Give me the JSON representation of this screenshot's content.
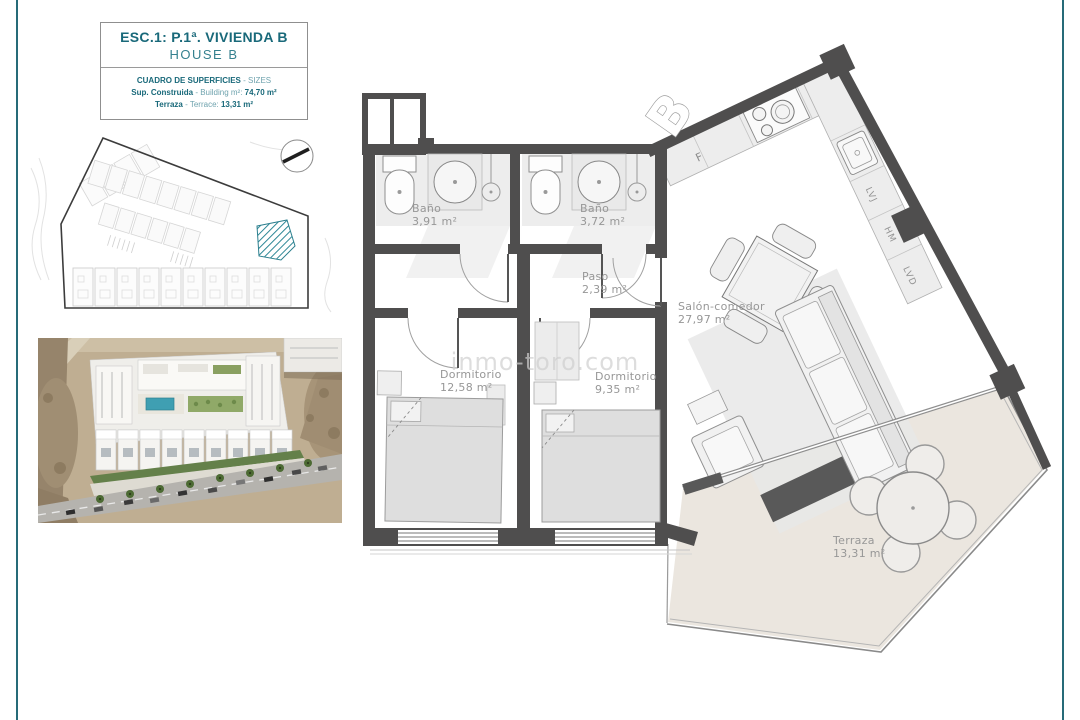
{
  "page": {
    "bg": "#ffffff",
    "frame_color": "#266b78"
  },
  "title_box": {
    "line1": "ESC.1: P.1ª. VIVIENDA B",
    "line2": "HOUSE B",
    "sizes_title": "CUADRO DE SUPERFICIES",
    "sizes_title_suffix": "- SIZES",
    "built_label": "Sup. Construida",
    "built_mid": "- Building m²:",
    "built_value": "74,70 m²",
    "terrace_label": "Terraza",
    "terrace_mid": "- Terrace:",
    "terrace_value": "13,31 m²"
  },
  "site_plan": {
    "highlight_color": "#2e8897"
  },
  "floor_plan": {
    "unit_letter": "B",
    "kitchen_fridge_label": "F",
    "appliances": [
      "LVJ",
      "HM",
      "LVD"
    ],
    "rooms": {
      "bath1": {
        "name": "Baño",
        "area": "3,91 m²"
      },
      "bath2": {
        "name": "Baño",
        "area": "3,72 m²"
      },
      "paso": {
        "name": "Paso",
        "area": "2,39 m²"
      },
      "salon": {
        "name": "Salón-comedor",
        "area": "27,97 m²"
      },
      "dorm1": {
        "name": "Dormitorio",
        "area": "12,58 m²"
      },
      "dorm2": {
        "name": "Dormitorio",
        "area": "9,35 m²"
      },
      "terraza": {
        "name": "Terraza",
        "area": "13,31 m²"
      }
    }
  },
  "watermark": "inmo-toro.com"
}
